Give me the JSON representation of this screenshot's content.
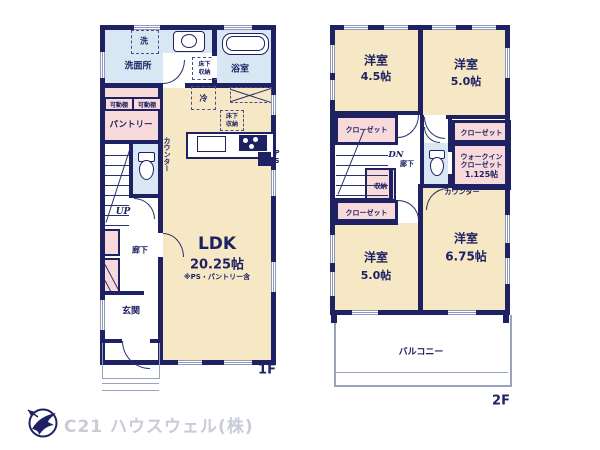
{
  "floor1": {
    "floor_label": "1F",
    "washer": "洗",
    "washroom": "洗面所",
    "bathroom": "浴室",
    "underfloor_storage_a": "床下収納",
    "underfloor_storage_b": "床下収納",
    "fridge": "冷",
    "movable_shelf_a": "可動棚",
    "movable_shelf_b": "可動棚",
    "pantry": "パントリー",
    "counter": "カウンター",
    "pipe_space": "PS",
    "stairs_up": "UP",
    "hallway": "廊下",
    "entrance": "玄関",
    "ldk_name": "LDK",
    "ldk_size": "20.25帖",
    "ldk_note": "※PS・パントリー含"
  },
  "floor2": {
    "floor_label": "2F",
    "room_top_left_name": "洋室",
    "room_top_left_size": "4.5帖",
    "room_top_right_name": "洋室",
    "room_top_right_size": "5.0帖",
    "room_bottom_left_name": "洋室",
    "room_bottom_left_size": "5.0帖",
    "room_bottom_right_name": "洋室",
    "room_bottom_right_size": "6.75帖",
    "closet_a": "クローゼット",
    "closet_b": "クローゼット",
    "closet_c": "クローゼット",
    "walkin_closet_name": "ウォークインクローゼット",
    "walkin_closet_size": "1.125帖",
    "stairs_down": "DN",
    "hallway": "廊下",
    "storage": "収納",
    "counter": "カウンター",
    "balcony": "バルコニー"
  },
  "footer": {
    "company": "C21 ハウスウェル(株)"
  },
  "colors": {
    "wall": "#1e2263",
    "room": "#f7e8c5",
    "wet_area": "#d9e7f4",
    "closet": "#f8dada",
    "footer_text": "#c9ccd6"
  }
}
